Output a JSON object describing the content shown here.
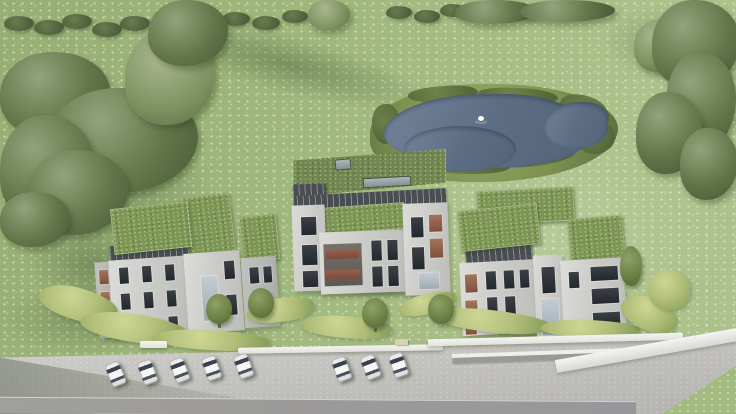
{
  "scene": {
    "description": "Aerial 3D architectural rendering: three modern apartment buildings with planted green roofs set in a flowering meadow, a pond with a single swan, hedgerows and mature trees at the edges, winding garden hedges, and a lower access road with a row of parked white cars and a ramped garage entrance",
    "building_count": 3,
    "car_count": 8,
    "swan_count": 1,
    "pond_count": 1
  },
  "colors": {
    "grass-base": "#a3ba80",
    "grass-light": "#c3d49e",
    "tree-dark": "#4d5f3c",
    "tree-mid": "#637549",
    "tree-light": "#93a37c",
    "hedge-garden": "#b0bd77",
    "reed": "#7e9150",
    "pond-water": "#5d6e84",
    "pond-water-light": "#72839a",
    "roof-green": "#7d9655",
    "facade-dark": "#4a4e52",
    "wall-light": "#c9c9c6",
    "wall-mid": "#bcbcb9",
    "wall-shaded": "#a9a9a6",
    "window-dark": "#23282d",
    "window-warm": "#7e4f3e",
    "terrace-wood": "#7c4b3c",
    "glass-light": "#c3ccd2",
    "road-light": "#d2d1cd",
    "road-mid": "#b4b3af",
    "road-dark": "#a09f9b",
    "wall-white": "#e2e1dc",
    "car-body": "#f5f6f5",
    "car-glass": "#39424c",
    "swan": "#ffffff"
  }
}
